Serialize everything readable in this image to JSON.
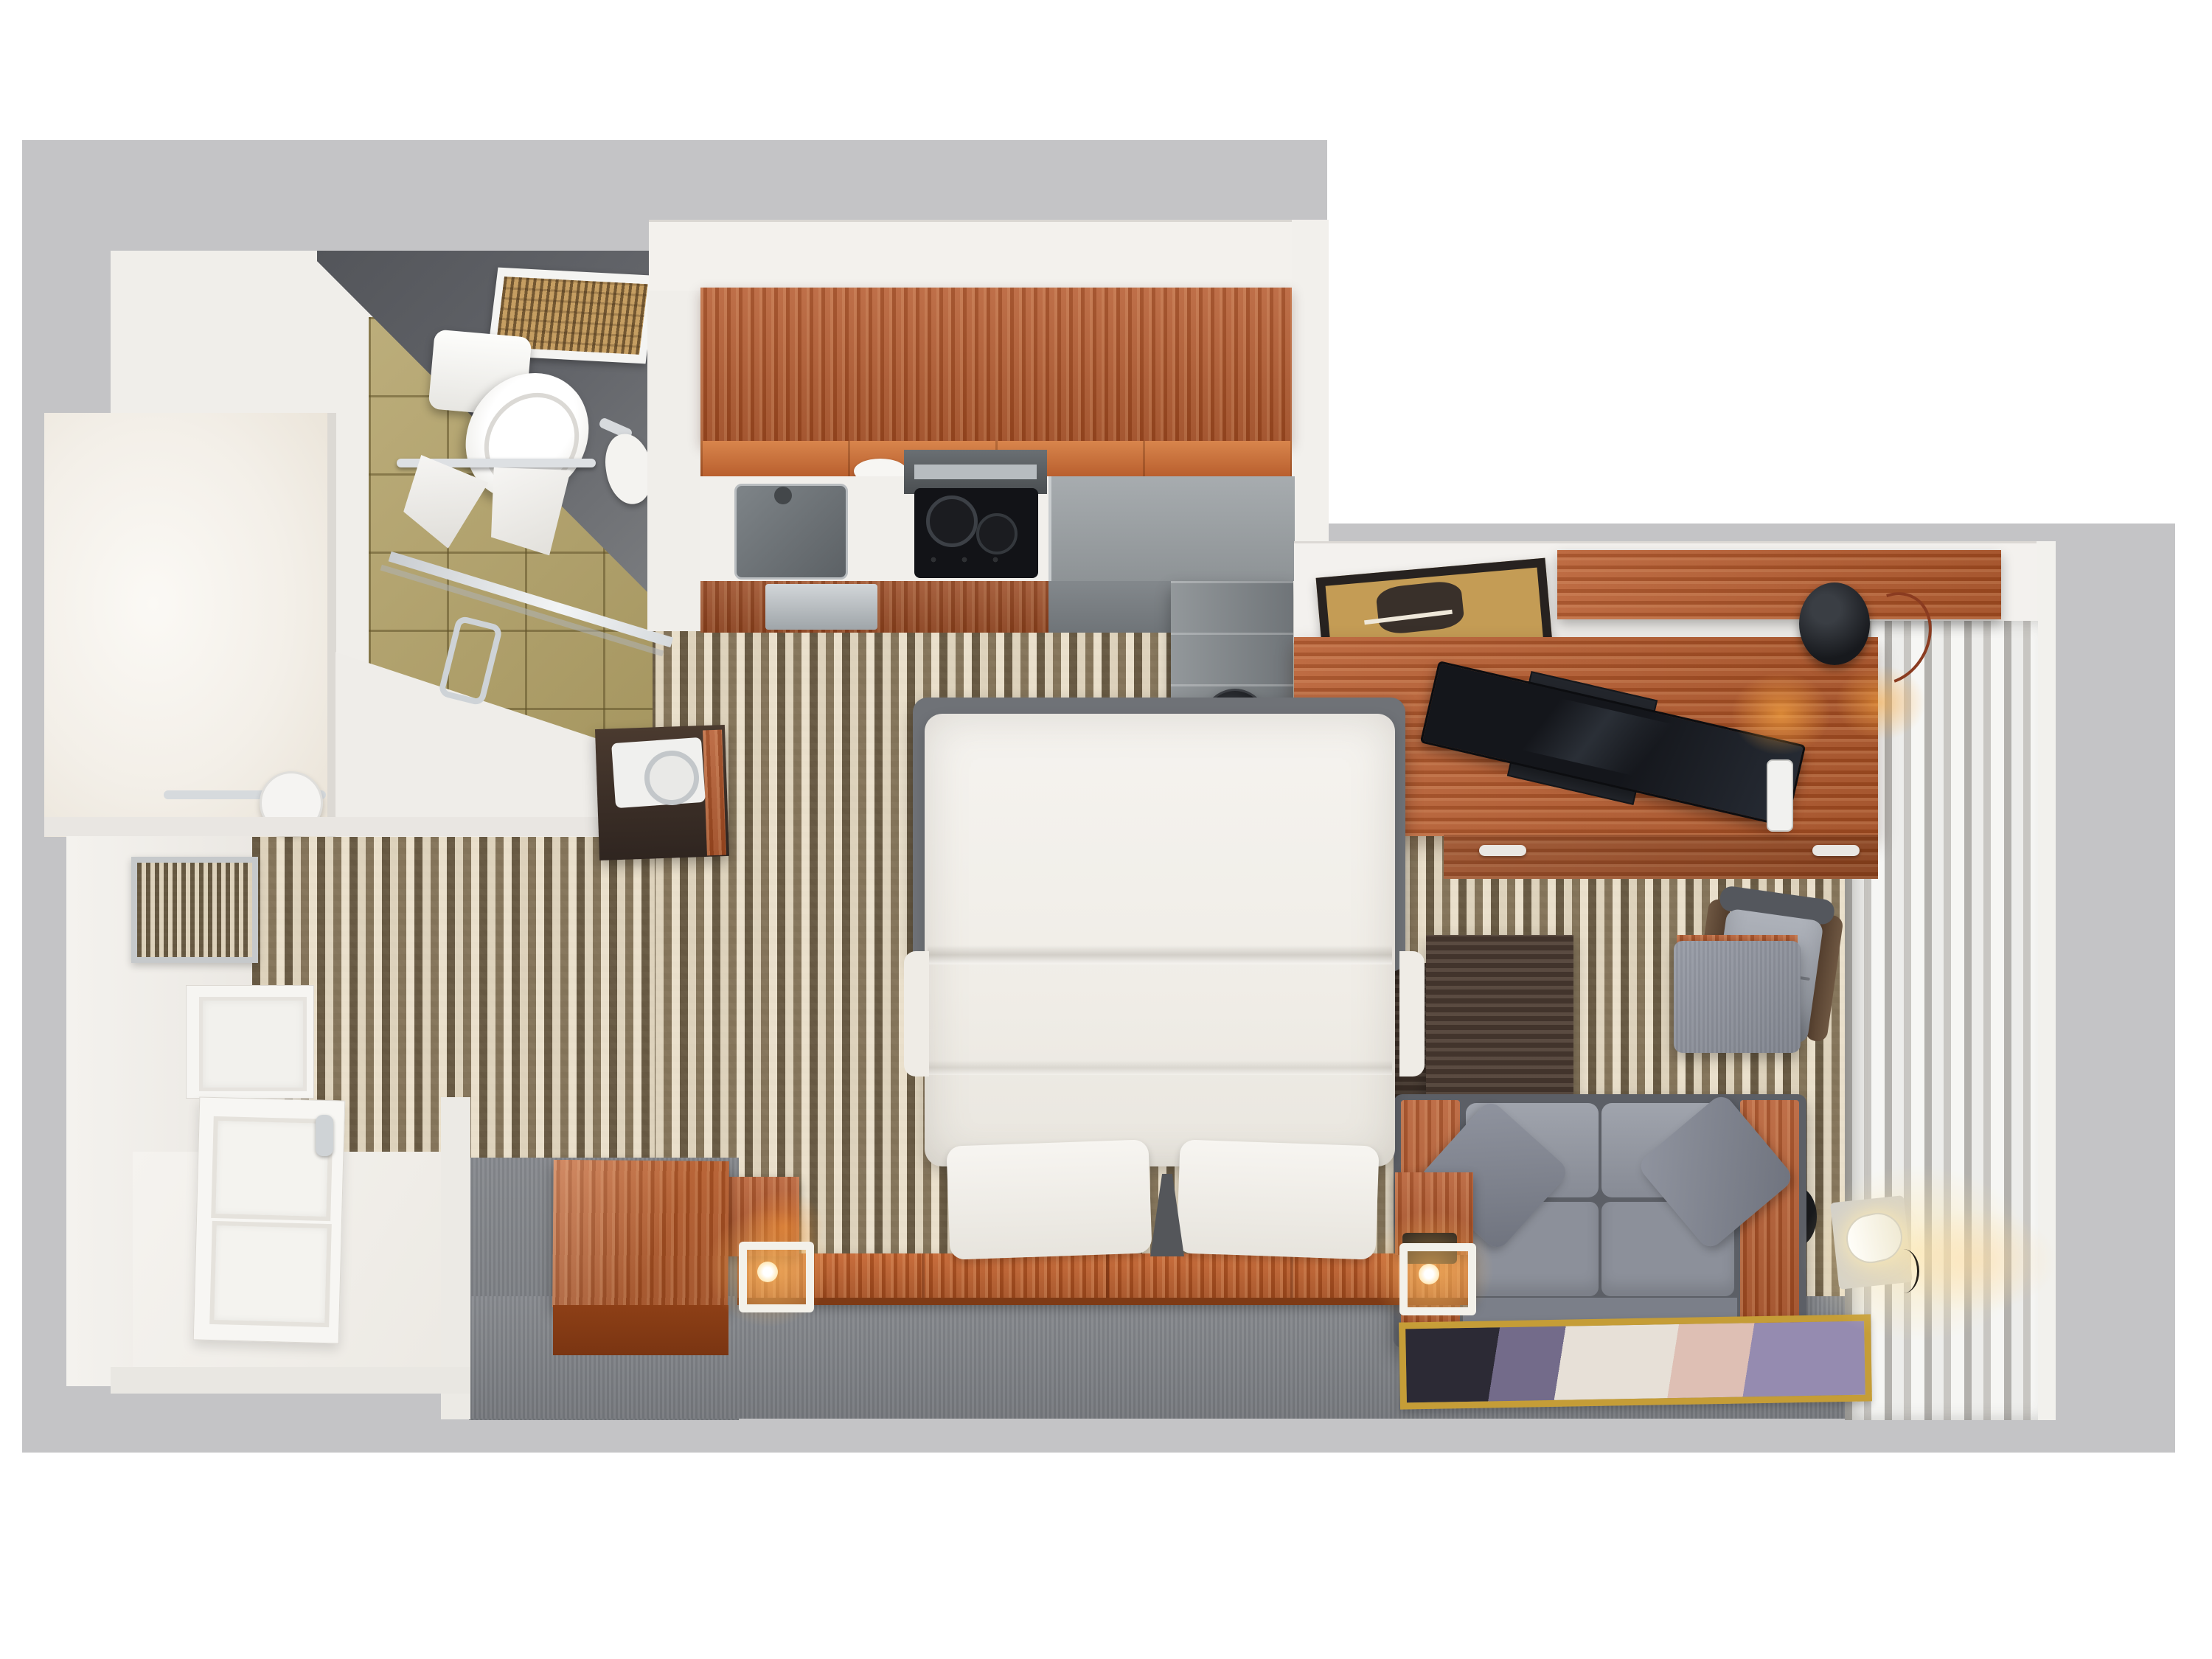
{
  "scene": {
    "title": "Hotel studio suite — 3D top-down floor plan render",
    "type": "3d-floor-plan",
    "visible_text": "none"
  },
  "palette": {
    "page_background": "#ffffff",
    "plan_background": "#c4c4c6",
    "wall_white": "#f1efeb",
    "ceiling_gray": "#5a5c60",
    "tile_tan": "#b1a065",
    "carpet_cream": "#ddd2b6",
    "carpet_brown": "#6b5d48",
    "carpet_gray": "#7f8287",
    "wood_cherry": "#b25427",
    "wood_walnut": "#4d3d33",
    "sofa_gray": "#8c909a",
    "accent_glow": "#ffb142",
    "rug_gold": "#c59d37"
  },
  "rooms": {
    "bathroom": {
      "label": "Bathroom",
      "items": [
        "ceiling exhaust vent",
        "towel bar with two towels",
        "robe hook",
        "toilet",
        "glass shower door with handle",
        "tan tile floor",
        "vanity nook with bar and paper roll"
      ]
    },
    "hallway": {
      "label": "Entry hallway",
      "items": [
        "framed wall mirror",
        "herringbone carpet",
        "white paneled closet front",
        "white paneled entry door",
        "dark wall cabinet with dial"
      ]
    },
    "kitchenette": {
      "label": "Kitchenette",
      "items": [
        "wood upper cabinets",
        "two white bowls",
        "stainless sink with faucet",
        "cooktop with hood and burners",
        "stainless counter",
        "dishwasher",
        "refrigerator"
      ]
    },
    "bedroom": {
      "label": "Bedroom area",
      "items": [
        "double bed with white duvet",
        "two white pillows",
        "wood headboard platform",
        "left nightstand",
        "right nightstand with black tray",
        "two glowing cube lamps",
        "wood storage chest"
      ]
    },
    "living": {
      "label": "Living / work area",
      "items": [
        "framed picture",
        "floating wood shelf",
        "wood desk with flat TV",
        "desk lamp with cord",
        "phone handset",
        "desk drawers",
        "office chair",
        "trash can",
        "nesting coffee tables",
        "gray ottoman",
        "gray loveseat with wood arms and throw pillows",
        "round black side table",
        "glowing floor lamp",
        "abstract area rug",
        "sheer curtains along window wall"
      ]
    }
  }
}
